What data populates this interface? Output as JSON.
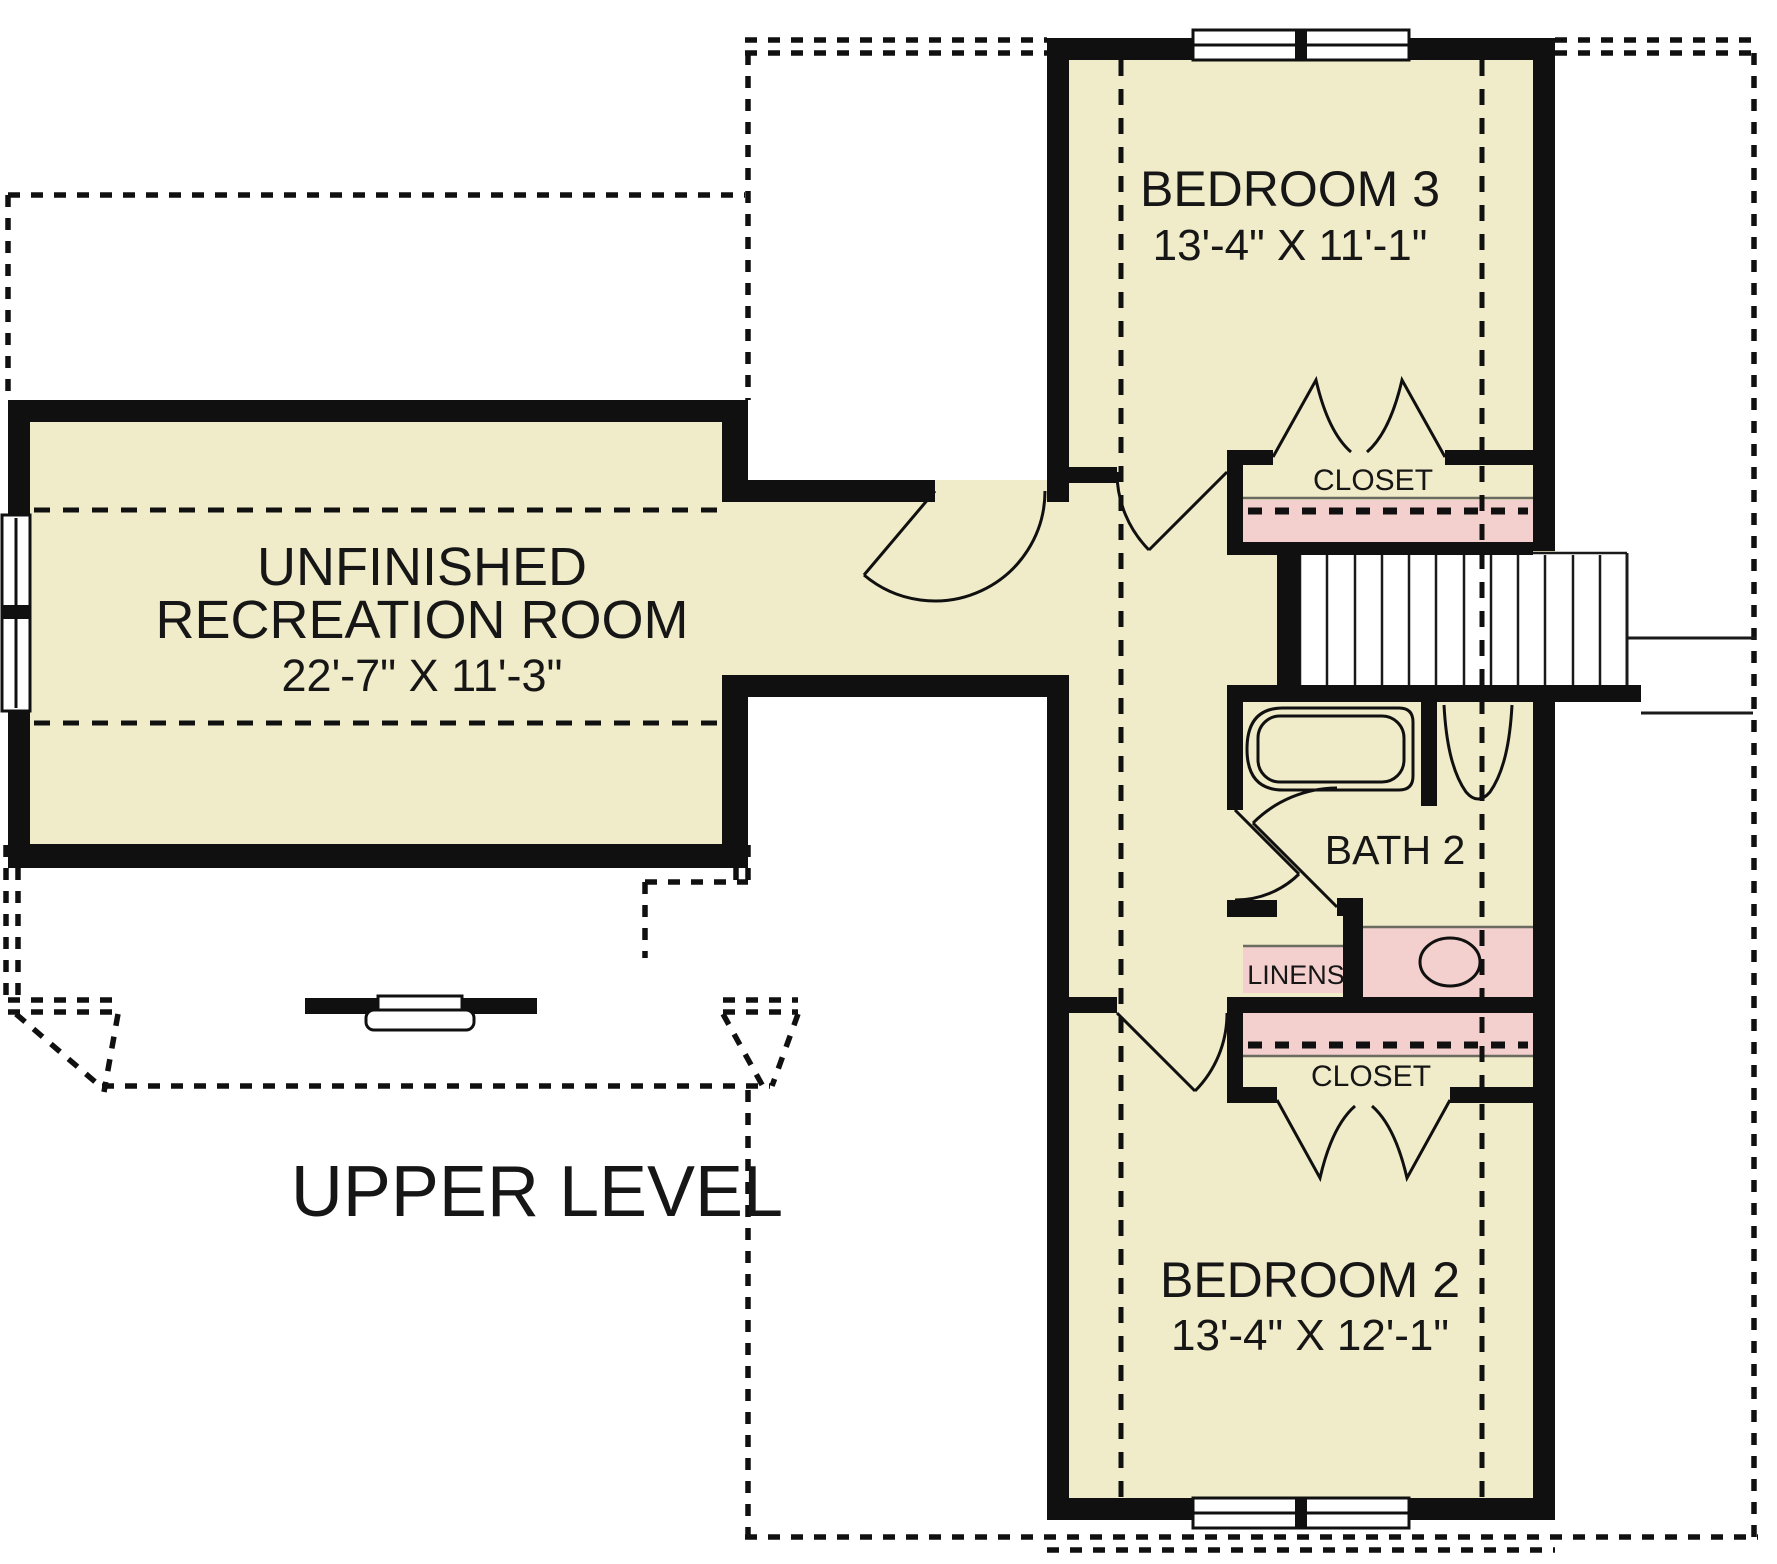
{
  "plan": {
    "level_label": "UPPER LEVEL",
    "rooms": {
      "recreation": {
        "line1": "UNFINISHED",
        "line2": "RECREATION ROOM",
        "dims": "22'-7\" X 11'-3\""
      },
      "bedroom3": {
        "name": "BEDROOM 3",
        "dims": "13'-4\" X 11'-1\""
      },
      "bedroom2": {
        "name": "BEDROOM 2",
        "dims": "13'-4\" X 12'-1\""
      },
      "bath2": {
        "name": "BATH 2"
      },
      "closet_bedroom3": {
        "name": "CLOSET"
      },
      "closet_bedroom2": {
        "name": "CLOSET"
      },
      "linens": {
        "name": "LINENS"
      }
    },
    "colors": {
      "floor": "#f0ebc8",
      "closet": "#f3d0ce",
      "wall": "#101010"
    }
  }
}
